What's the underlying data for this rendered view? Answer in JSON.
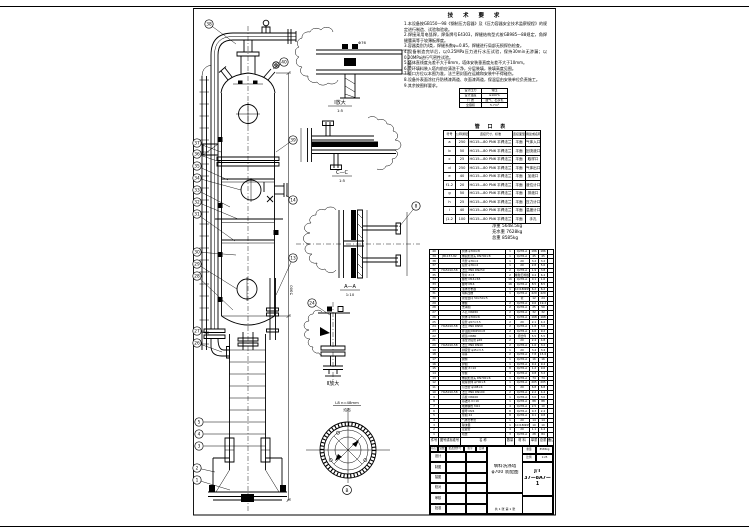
{
  "notes": {
    "title": "技 术 要 求",
    "items": [
      "1.本设备按GB150—98《钢制压力容器》及《压力容器安全技术监察规程》的规定进行制造、试验和验收。",
      "2.焊接采用电弧焊，焊条牌号E4303，焊缝结构型式按GB985—88规定，角焊缝腰高等于较薄板厚度。",
      "3.容器类别为Ⅰ类，焊缝系数φ=0.85，焊缝进行局部无损探伤检查。",
      "4.设备制造完毕后，以0.25MPa压力进行水压试验，保持30min无渗漏；以0.20MPa进行气密性试验。",
      "5.塔体直线度允差不大于8mm，塔体安装垂直度允差不大于10mm。",
      "6.瓷环填料装入塔内前应清洗干净，分层装填，装填高度见图。",
      "7.管口方位以本图为准，法兰密封面在运输和安装中不得碰伤。",
      "8.设备外表面涂红丹防锈漆两道、灰面漆两道，保温层由安装单位负责施工。",
      "9.其余按图样要求。"
    ]
  },
  "param_table": {
    "rows": [
      [
        "设计压力",
        "常压"
      ],
      [
        "设计温度",
        "≤100℃"
      ],
      [
        "介 质",
        "废气、石灰乳"
      ],
      [
        "全容积",
        "5.7m³"
      ]
    ]
  },
  "nozzle_table": {
    "title": "管 口 表",
    "headers": [
      "符号",
      "公称通径",
      "连接尺寸、标准",
      "连接面型式",
      "用途或名称"
    ],
    "rows": [
      [
        "a",
        "250",
        "HG15—80 PN6 平焊法兰",
        "平面",
        "气体入口"
      ],
      [
        "b",
        "50",
        "HG15—80 PN6 平焊法兰",
        "平面",
        "回流液口"
      ],
      [
        "c",
        "25",
        "HG15—80 PN6 平焊法兰",
        "平面",
        "取样口"
      ],
      [
        "d",
        "250",
        "HG15—80 PN6 平焊法兰",
        "平面",
        "气体出口"
      ],
      [
        "e",
        "40",
        "HG15—80 PN6 平焊法兰",
        "平面",
        "加液口"
      ],
      [
        "f1-2",
        "20",
        "HG15—80 PN6 平焊法兰",
        "平面",
        "液位计口"
      ],
      [
        "g",
        "50",
        "HG15—80 PN6 平焊法兰",
        "平面",
        "排液口"
      ],
      [
        "h",
        "25",
        "HG15—80 PN6 平焊法兰",
        "平面",
        "压力计口"
      ],
      [
        "i",
        "40",
        "HG15—80 PN6 平焊法兰",
        "平面",
        "温度计口"
      ],
      [
        "j1-2",
        "100",
        "HG15—80 PN6 平焊法兰",
        "平面",
        "手孔"
      ]
    ]
  },
  "weights": [
    "净重 5648.5kg",
    "充水重 7628kg",
    "总重 8585kg"
  ],
  "bom": {
    "headers": [
      "件号",
      "图号或标准号",
      "名  称",
      "数量",
      "材 料",
      "单重",
      "总重",
      "备注"
    ],
    "rows": [
      [
        "40",
        "",
        "筒体 φ700×8",
        "1",
        "Q235-A",
        "186",
        "186",
        ""
      ],
      [
        "39",
        "JB1157-82",
        "椭圆形封头 DN700×8",
        "1",
        "Q235-A",
        "45",
        "45",
        ""
      ],
      [
        "38",
        "",
        "弯管 φ76×4",
        "1",
        "20",
        "3.2",
        "3.2",
        ""
      ],
      [
        "37",
        "",
        "接管 φ76×4",
        "1",
        "20",
        "2.8",
        "5.6",
        ""
      ],
      [
        "36",
        "HG5010-58",
        "法兰 PN6 DN250",
        "2",
        "Q235-A",
        "1.9",
        "3.8",
        ""
      ],
      [
        "35",
        "",
        "垫片 δ=3",
        "2",
        "橡胶石棉板",
        "0.4",
        "6.4",
        ""
      ],
      [
        "34",
        "",
        "螺栓 M16×65",
        "16",
        "Q235-A",
        "0.1",
        "1.6",
        ""
      ],
      [
        "33",
        "",
        "螺母 M16",
        "16",
        "Q235-A",
        "8.5",
        "8.5",
        ""
      ],
      [
        "32",
        "",
        "液体分布器",
        "1",
        "1Cr18Ni9Ti",
        "6.2",
        "6.2",
        ""
      ],
      [
        "31",
        "",
        "填料压栅",
        "1",
        "Q235-A",
        "420",
        "420",
        ""
      ],
      [
        "30",
        "",
        "瓷拉西环 50×50×5",
        "",
        "瓷",
        "12",
        "24",
        ""
      ],
      [
        "29",
        "",
        "栅板",
        "2",
        "Q235-A",
        "9.6",
        "19.2",
        ""
      ],
      [
        "28",
        "",
        "支承圈",
        "2",
        "Q235-A",
        "25",
        "50",
        ""
      ],
      [
        "27",
        "",
        "人孔 DN450",
        "2",
        "Q235-A",
        "32",
        "32",
        ""
      ],
      [
        "26",
        "",
        "筒体 φ700×6",
        "1",
        "Q235-A",
        "168",
        "168",
        ""
      ],
      [
        "25",
        "",
        "接管 φ57×3.5",
        "2",
        "20",
        "2.1",
        "4.2",
        ""
      ],
      [
        "24",
        "HG5010-58",
        "法兰 PN6 DN50",
        "2",
        "Q235-A",
        "1.8",
        "3.6",
        ""
      ],
      [
        "23",
        "",
        "补强圈 DN250×8",
        "2",
        "Q235-A",
        "4.6",
        "9.2",
        ""
      ],
      [
        "22",
        "",
        "视镜 DN80",
        "1",
        "组合件",
        "5.5",
        "5.5",
        ""
      ],
      [
        "21",
        "",
        "液位计接管 φ45",
        "2",
        "20",
        "2.4",
        "4.8",
        ""
      ],
      [
        "20",
        "HG5010-58",
        "法兰 PN6 DN40",
        "2",
        "Q235-A",
        "1.6",
        "3.2",
        ""
      ],
      [
        "19",
        "",
        "排液管 φ45×3.5",
        "1",
        "20",
        "3.4",
        "3.4",
        ""
      ],
      [
        "18",
        "",
        "吊耳",
        "2",
        "Q235-A",
        "7.8",
        "15.6",
        ""
      ],
      [
        "17",
        "",
        "爬梯",
        "1",
        "Q235-A",
        "16",
        "16",
        ""
      ],
      [
        "16",
        "",
        "护圈",
        "1",
        "Q235-A",
        "9.4",
        "9.4",
        ""
      ],
      [
        "15",
        "",
        "筋板 δ=10",
        "8",
        "Q235-A",
        "1.2",
        "9.6",
        ""
      ],
      [
        "14",
        "",
        "垫板",
        "4",
        "Q235-A",
        "0.8",
        "3.2",
        ""
      ],
      [
        "13",
        "",
        "椭圆形封头 DN700×6",
        "1",
        "Q235-A",
        "74",
        "74",
        ""
      ],
      [
        "12",
        "",
        "裙座筒体 φ700×8",
        "1",
        "Q235-A",
        "205",
        "205",
        ""
      ],
      [
        "11",
        "",
        "引出管 φ108×4",
        "1",
        "20",
        "6.8",
        "6.8",
        ""
      ],
      [
        "10",
        "HG5010-58",
        "法兰 PN6 DN100",
        "2",
        "Q235-A",
        "2.2",
        "4.4",
        ""
      ],
      [
        "9",
        "",
        "盲板 DN100",
        "1",
        "Q235-A",
        "3.0",
        "3.0",
        ""
      ],
      [
        "8",
        "",
        "基础环 δ=16",
        "1",
        "Q235-A",
        "88",
        "88",
        ""
      ],
      [
        "7",
        "",
        "地脚螺栓 M24",
        "4",
        "Q235-A",
        "2.5",
        "10",
        ""
      ],
      [
        "6",
        "",
        "螺母 M24",
        "8",
        "Q235-A",
        "0.3",
        "2.4",
        ""
      ],
      [
        "5",
        "",
        "垫圈 24",
        "8",
        "Q235-A",
        "0.1",
        "0.8",
        ""
      ],
      [
        "4",
        "",
        "气体分布管",
        "1",
        "20",
        "14",
        "14",
        ""
      ],
      [
        "3",
        "",
        "除沫器",
        "1",
        "1Cr18Ni9Ti",
        "10",
        "10",
        ""
      ],
      [
        "2",
        "",
        "定距管",
        "4",
        "20",
        "1.1",
        "4.4",
        ""
      ],
      [
        "1",
        "",
        "塔盘",
        "3",
        "Q235-A",
        "28",
        "84",
        ""
      ]
    ]
  },
  "title_block": {
    "strip": [
      "标记",
      "处数",
      "更改文件号",
      "签字",
      "日期"
    ],
    "sig_rows": [
      "设计",
      "制图",
      "描图",
      "校对",
      "审核",
      "批准"
    ],
    "name_line1": "填料洗涤塔",
    "name_line2": "φ700 装配图",
    "weight_label": "重量",
    "weight_value": "8585kg",
    "scale_label": "比例",
    "scale_value": "1:25",
    "dwg_prefix": "J/T",
    "dwg_no": "37—8A7—1",
    "sheet": "共 1 张  第 1 张"
  },
  "balloons": [
    "38",
    "37",
    "36",
    "35",
    "34",
    "33",
    "32",
    "31",
    "30",
    "29",
    "28",
    "27",
    "26",
    "5",
    "4",
    "3",
    "2",
    "1",
    "40",
    "39",
    "14",
    "13",
    "24",
    "8"
  ],
  "labels": {
    "detail1_name": "Ⅰ放大",
    "detail1_scale": "1:5",
    "detail1_dim": "Φ76",
    "dim_top": "450",
    "detail2_name": "C—C",
    "detail2_scale": "1:5",
    "detail3_name": "A—A",
    "detail3_scale": "1:10",
    "detail4_name": "Ⅱ放大",
    "viewb_note1": "L8 n=48mm",
    "viewb_note2": "均布",
    "viewb_label": "B",
    "dim_height": "5900"
  }
}
